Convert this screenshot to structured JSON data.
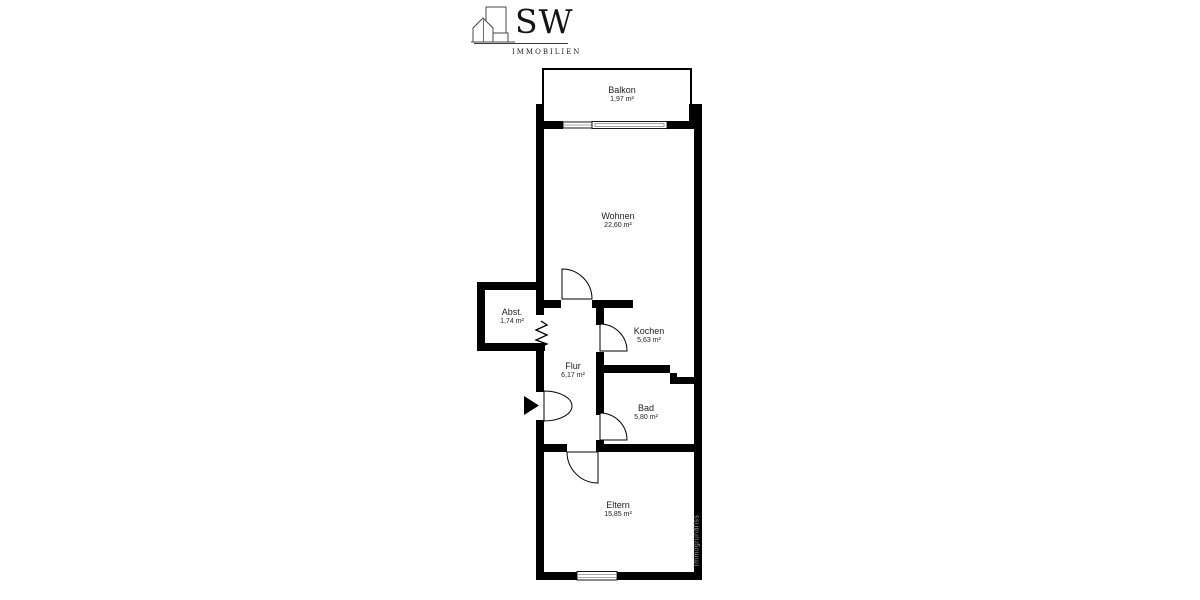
{
  "logo": {
    "icon": "buildings-icon",
    "brand": "SW",
    "subtitle": "IMMOBILIEN"
  },
  "watermark": "Immogrundriss",
  "rooms": [
    {
      "name": "Balkon",
      "area": "1,97 m²"
    },
    {
      "name": "Wohnen",
      "area": "22,60 m²"
    },
    {
      "name": "Abst.",
      "area": "1,74 m²"
    },
    {
      "name": "Kochen",
      "area": "5,63 m²"
    },
    {
      "name": "Flur",
      "area": "6,17 m²"
    },
    {
      "name": "Bad",
      "area": "5,80 m²"
    },
    {
      "name": "Eltern",
      "area": "15,85 m²"
    }
  ],
  "colors": {
    "wall": "#000000",
    "label": "#222222",
    "watermark": "#999999",
    "window_inner": "#8a8a8a"
  }
}
